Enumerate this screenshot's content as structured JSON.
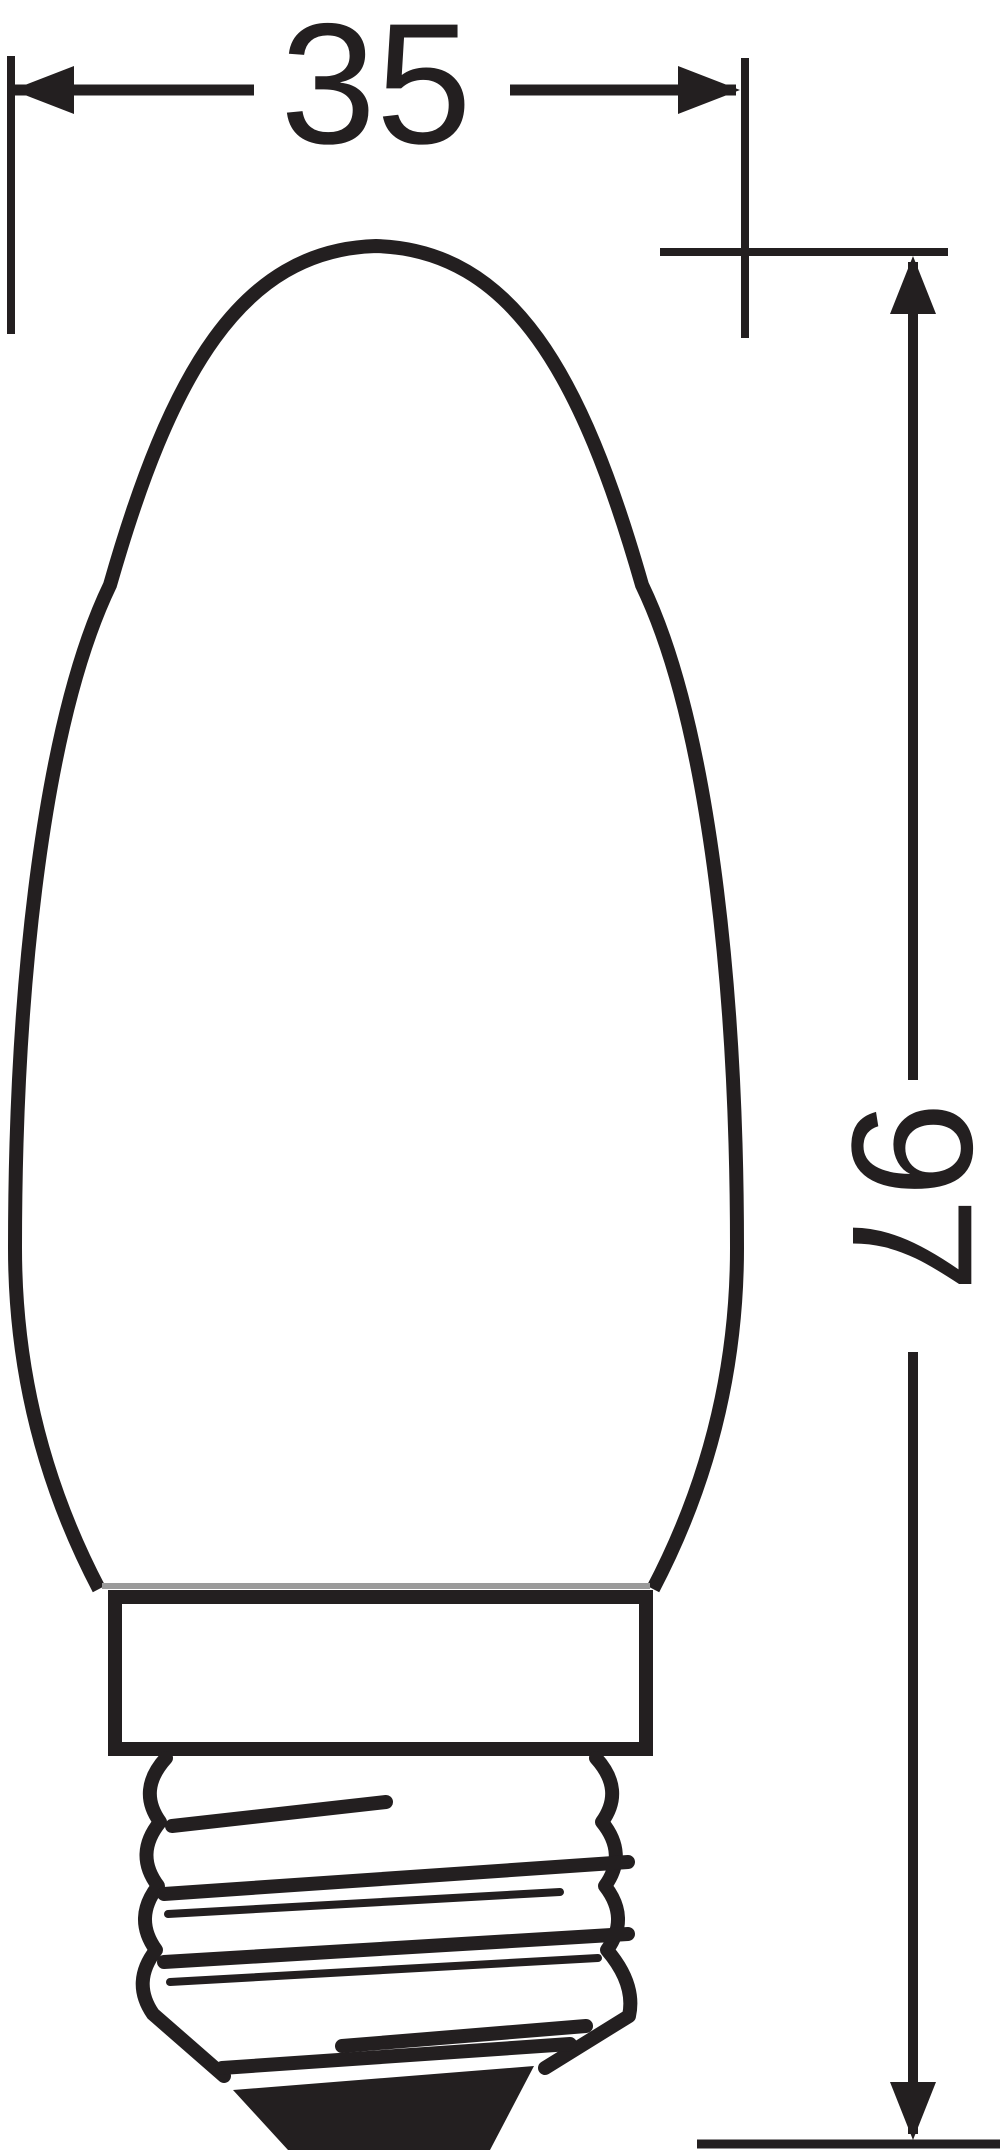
{
  "drawing": {
    "background_color": "#ffffff",
    "ink_color": "#231f20",
    "dimensions": {
      "width": {
        "value": "35"
      },
      "height": {
        "value": "97"
      }
    }
  }
}
